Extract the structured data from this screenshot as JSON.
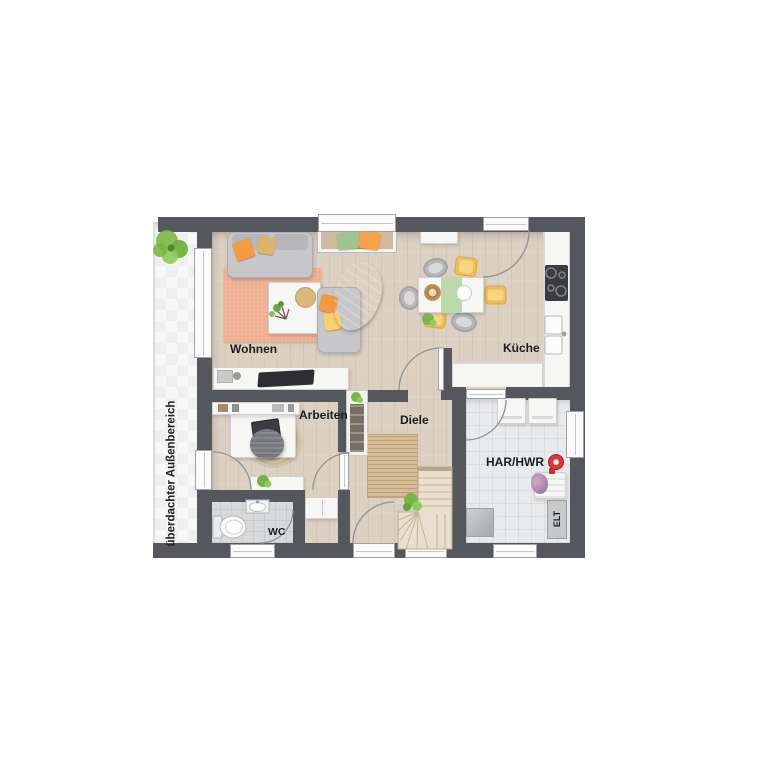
{
  "floorplan": {
    "rooms": {
      "wohnen": {
        "label": "Wohnen"
      },
      "kueche": {
        "label": "Küche"
      },
      "arbeiten": {
        "label": "Arbeiten"
      },
      "diele": {
        "label": "Diele"
      },
      "wc": {
        "label": "WC"
      },
      "har_hwr": {
        "label": "HAR/HWR"
      },
      "elt": {
        "label": "ELT"
      },
      "aussenbereich": {
        "label": "überdachter Außenbereich"
      }
    },
    "colors": {
      "wall": "#54575b",
      "wood_floor": "#dbd0c2",
      "wc_tile_floor": "#d8d9da",
      "har_tile_floor": "#e9eaeb",
      "outdoor_floor": "#f7f7f8",
      "rug_living": "#efb092",
      "rug_jute": "#d6bd96",
      "accent_orange": "#f59a40",
      "accent_yellow": "#f6d06e",
      "accent_green": "#bcd9ac",
      "plant_green": "#7fba49",
      "alert_red": "#e23535",
      "furniture_white": "#f6f6f5",
      "sofa_gray": "#c7c7c9"
    }
  }
}
